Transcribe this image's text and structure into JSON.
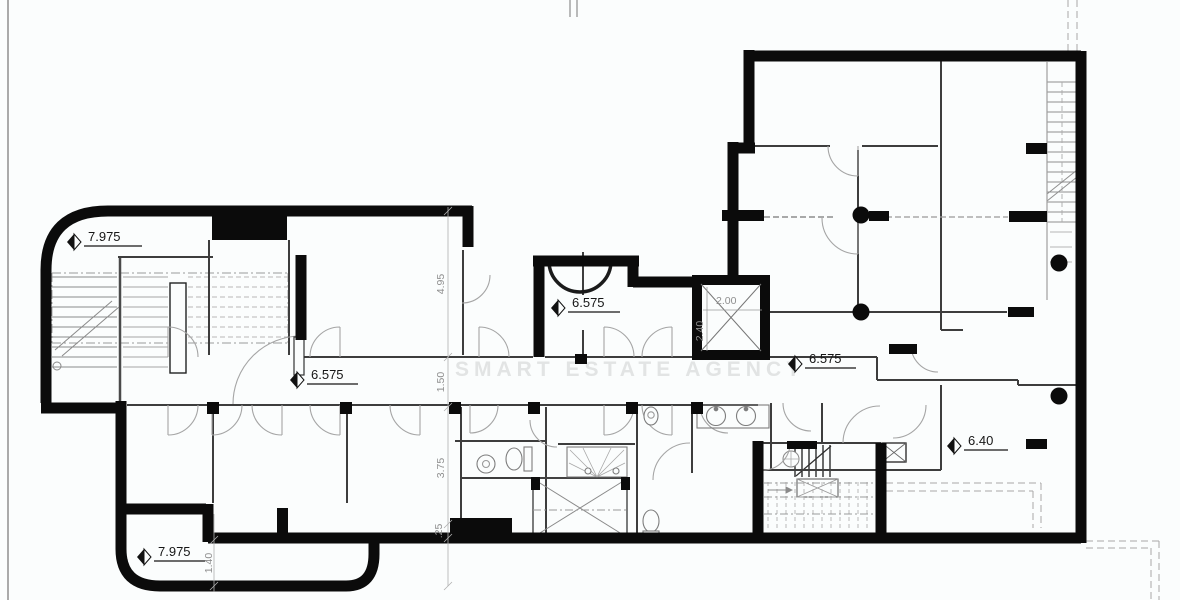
{
  "plan": {
    "watermark": "SMART ESTATE AGENCY",
    "levels": [
      {
        "id": "level-top-left",
        "value": "7.975"
      },
      {
        "id": "level-mid-room",
        "value": "6.575"
      },
      {
        "id": "level-corridor-left",
        "value": "6.575"
      },
      {
        "id": "level-corridor-right",
        "value": "6.575"
      },
      {
        "id": "level-right-hall",
        "value": "6.40"
      },
      {
        "id": "level-bottom-left",
        "value": "7.975"
      }
    ],
    "dims": {
      "d495": {
        "value": "4.95"
      },
      "d150": {
        "value": "1.50"
      },
      "d375": {
        "value": "3.75"
      },
      "d025": {
        "value": ".25"
      },
      "d140": {
        "value": "1.40"
      },
      "d200": {
        "value": "2.00"
      },
      "d240": {
        "value": "2.40"
      }
    }
  }
}
